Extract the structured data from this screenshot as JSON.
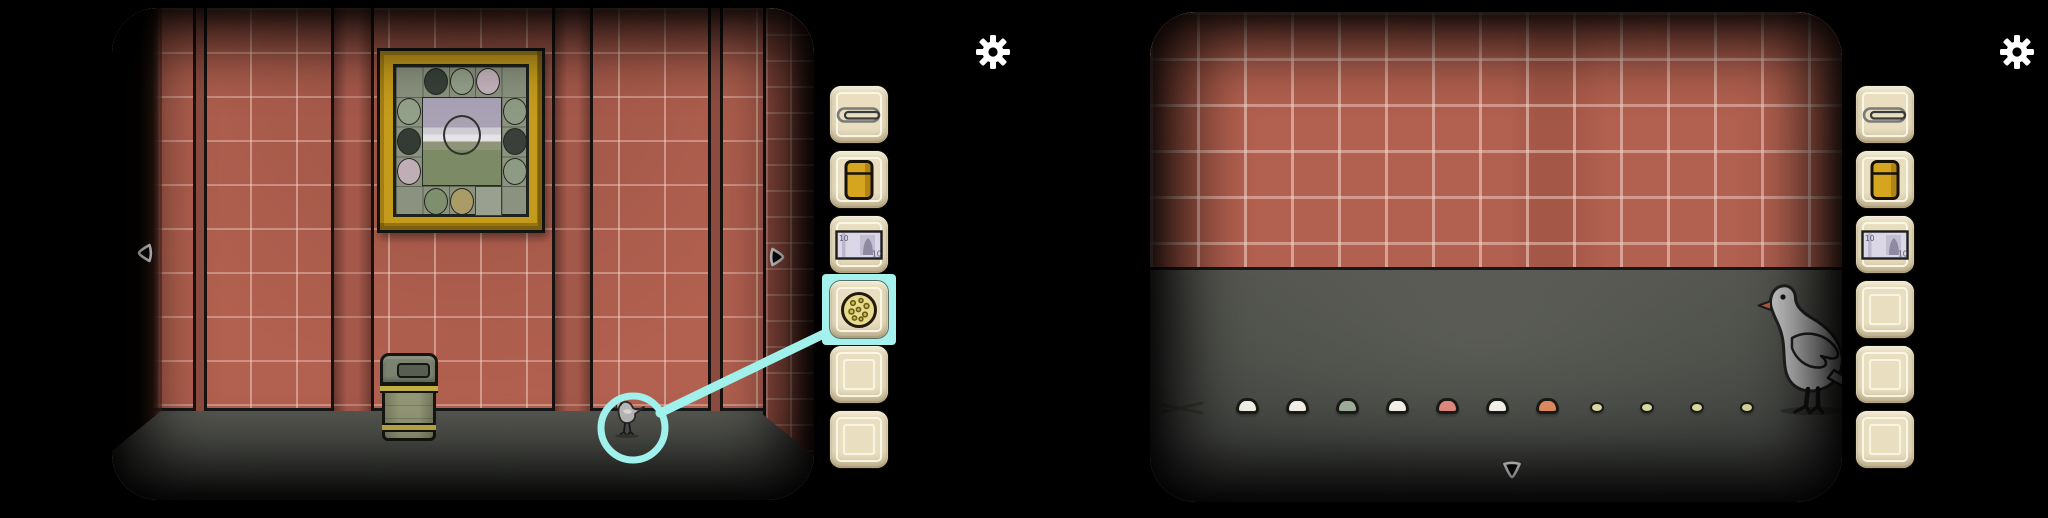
{
  "banknote_value": "10",
  "colors": {
    "background": "#000000",
    "wall": "#b2604f",
    "grout": "#f3d4c9",
    "floor": "#4a4c47",
    "slot_bg": "#e9dfc0",
    "selection_cyan": "#a0f1ec",
    "frame_gold": "#c59b1b",
    "lighter_gold": "#d6a51f",
    "bin_body": "#949776",
    "bin_band": "#c0ad45",
    "pigeon_gray": "#c6c6c6"
  },
  "left_scene": {
    "name": "tiled room view",
    "objects": [
      "framed circle-puzzle picture",
      "trash bin",
      "small pigeon on floor"
    ],
    "selection": {
      "tool": "cookie",
      "target": "pigeon",
      "indicator_color": "#a0f1ec"
    },
    "nav": {
      "left": "left-arrow",
      "right": "right-arrow"
    },
    "picture": {
      "frame": "gold",
      "missing_cell": "bottom-3",
      "landscape": {
        "sky": "#a9a2b4",
        "clouds": "#e6e3e7",
        "field": "#7d8a66",
        "has_center_ring": true
      },
      "border_circles": [
        {
          "pos": "top-1",
          "color": "#38403a",
          "pattern": "plaid"
        },
        {
          "pos": "top-2",
          "color": "#93a089",
          "pattern": "stripes"
        },
        {
          "pos": "top-3",
          "color": "#c6b4bd",
          "pattern": "plain"
        },
        {
          "pos": "right-1",
          "color": "#8d9a84",
          "pattern": "stripes"
        },
        {
          "pos": "right-2",
          "color": "#3a3f3a",
          "pattern": "stripes"
        },
        {
          "pos": "right-3",
          "color": "#8d9a84",
          "pattern": "stripes"
        },
        {
          "pos": "bottom-1",
          "color": "#7e8f6e",
          "pattern": "stripes"
        },
        {
          "pos": "bottom-2",
          "color": "#ab9b66",
          "pattern": "stripes"
        },
        {
          "pos": "left-1",
          "color": "#93a089",
          "pattern": "plain"
        },
        {
          "pos": "left-2",
          "color": "#343a34",
          "pattern": "plaid"
        },
        {
          "pos": "left-3",
          "color": "#c0aeb6",
          "pattern": "plain"
        }
      ]
    },
    "inventory": [
      {
        "item": "paperclip",
        "selected": false
      },
      {
        "item": "lighter",
        "selected": false
      },
      {
        "item": "banknote",
        "selected": false
      },
      {
        "item": "cookie",
        "selected": true
      },
      {
        "item": "",
        "selected": false
      },
      {
        "item": "",
        "selected": false
      }
    ]
  },
  "right_scene": {
    "name": "floor close-up with pigeon",
    "objects": [
      "large pigeon",
      "crumb trail",
      "scratch mark"
    ],
    "nav": {
      "down": "down-arrow"
    },
    "seeds": [
      {
        "x": 1247,
        "size": "large",
        "color": "#f4f1e8"
      },
      {
        "x": 1297,
        "size": "large",
        "color": "#f4f1e8"
      },
      {
        "x": 1347,
        "size": "large",
        "color": "#9fae9b"
      },
      {
        "x": 1397,
        "size": "large",
        "color": "#f4f1e8"
      },
      {
        "x": 1447,
        "size": "large",
        "color": "#e0887d"
      },
      {
        "x": 1497,
        "size": "large",
        "color": "#f4f1e8"
      },
      {
        "x": 1547,
        "size": "large",
        "color": "#de8a61"
      },
      {
        "x": 1597,
        "size": "small",
        "color": "#ddd9a3"
      },
      {
        "x": 1647,
        "size": "small",
        "color": "#d9dba4"
      },
      {
        "x": 1697,
        "size": "small",
        "color": "#dbd8a0"
      },
      {
        "x": 1747,
        "size": "small",
        "color": "#d6d39c"
      }
    ],
    "inventory": [
      {
        "item": "paperclip",
        "selected": false
      },
      {
        "item": "lighter",
        "selected": false
      },
      {
        "item": "banknote",
        "selected": false
      },
      {
        "item": "",
        "selected": false
      },
      {
        "item": "",
        "selected": false
      },
      {
        "item": "",
        "selected": false
      }
    ]
  }
}
